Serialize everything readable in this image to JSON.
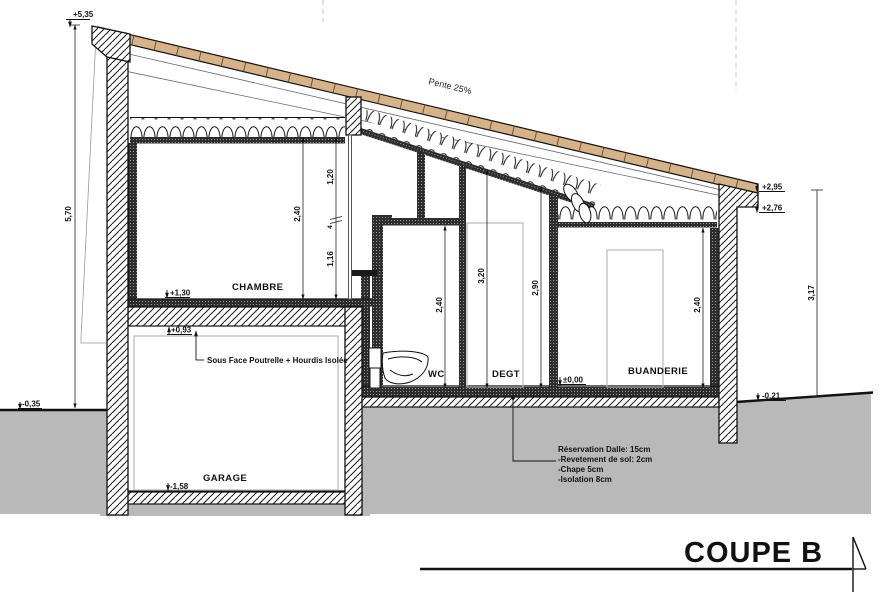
{
  "title": "COUPE B",
  "roof": {
    "slope_label": "Pente 25%"
  },
  "rooms": {
    "chambre": "CHAMBRE",
    "garage": "GARAGE",
    "wc": "WC",
    "degt": "DEGT",
    "buanderie": "BUANDERIE"
  },
  "levels": {
    "l535": "+5,35",
    "l035": "-0,35",
    "l130": "+1,30",
    "l093": "+0,93",
    "l158": "-1,58",
    "l000": "±0,00",
    "l295": "+2,95",
    "l276": "+2,76",
    "l021": "-0,21"
  },
  "dims": {
    "d570": "5,70",
    "chambre_h": "2,40",
    "seg120": "1,20",
    "seg4": "4",
    "seg116": "1,16",
    "wc_h": "2,40",
    "degt_h1": "3,20",
    "degt_h2": "2,90",
    "buanderie_h": "2,40",
    "right_h": "3,17"
  },
  "annotations": {
    "soffit": "Sous Face Poutrelle + Hourdis Isolée",
    "slab_note": [
      "Réservation Dalle: 15cm",
      "-Revetement de sol: 2cm",
      "-Chape 5cm",
      "-Isolation 8cm"
    ]
  },
  "colors": {
    "roof_wood": "#d5b288",
    "roof_joint": "#6b5335",
    "ground": "#b9b9b9",
    "line": "#111111"
  }
}
